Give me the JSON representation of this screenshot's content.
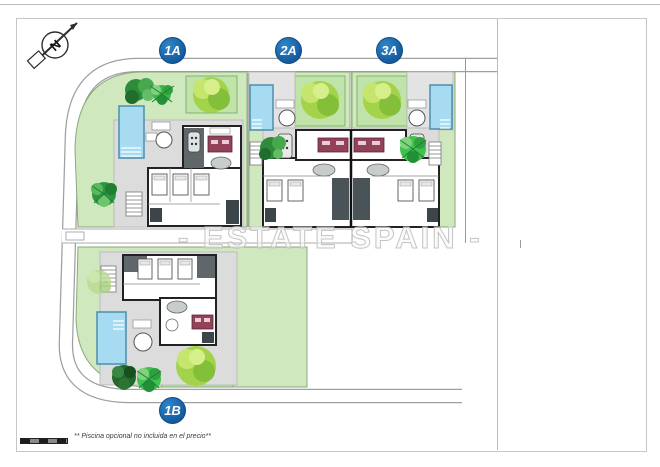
{
  "badges": {
    "plot_1a": "1A",
    "plot_2a": "2A",
    "plot_3a": "3A",
    "plot_1b": "1B"
  },
  "watermark": {
    "text": "- ESTATE SPAIN -"
  },
  "footnote": {
    "text": "** Piscina opcional no incluida en el precio**"
  },
  "compass": {
    "label": "N"
  },
  "plots": [
    {
      "id": "1A",
      "elements": [
        "villa",
        "pool",
        "terrace",
        "lawn",
        "trees"
      ]
    },
    {
      "id": "2A",
      "elements": [
        "villa",
        "pool",
        "terrace",
        "lawn",
        "trees"
      ]
    },
    {
      "id": "3A",
      "elements": [
        "villa",
        "pool",
        "terrace",
        "lawn",
        "trees"
      ]
    },
    {
      "id": "1B",
      "elements": [
        "villa",
        "pool",
        "terrace",
        "lawn",
        "trees"
      ]
    }
  ],
  "colors": {
    "lawn": "#cfe8bd",
    "lawn_border": "#8aa97a",
    "tree_patch": "#bfe3a8",
    "pool_water": "#a7dbf1",
    "pool_border": "#4a8fae",
    "terrace": "#dcdcdc",
    "wall": "#222222",
    "roof_dark": "#5f676b",
    "kitchen_red": "#93425a",
    "badge_blue": "#155a9d",
    "road_edge": "#9f9f9f",
    "watermark_gray": "#c4c4c4"
  }
}
